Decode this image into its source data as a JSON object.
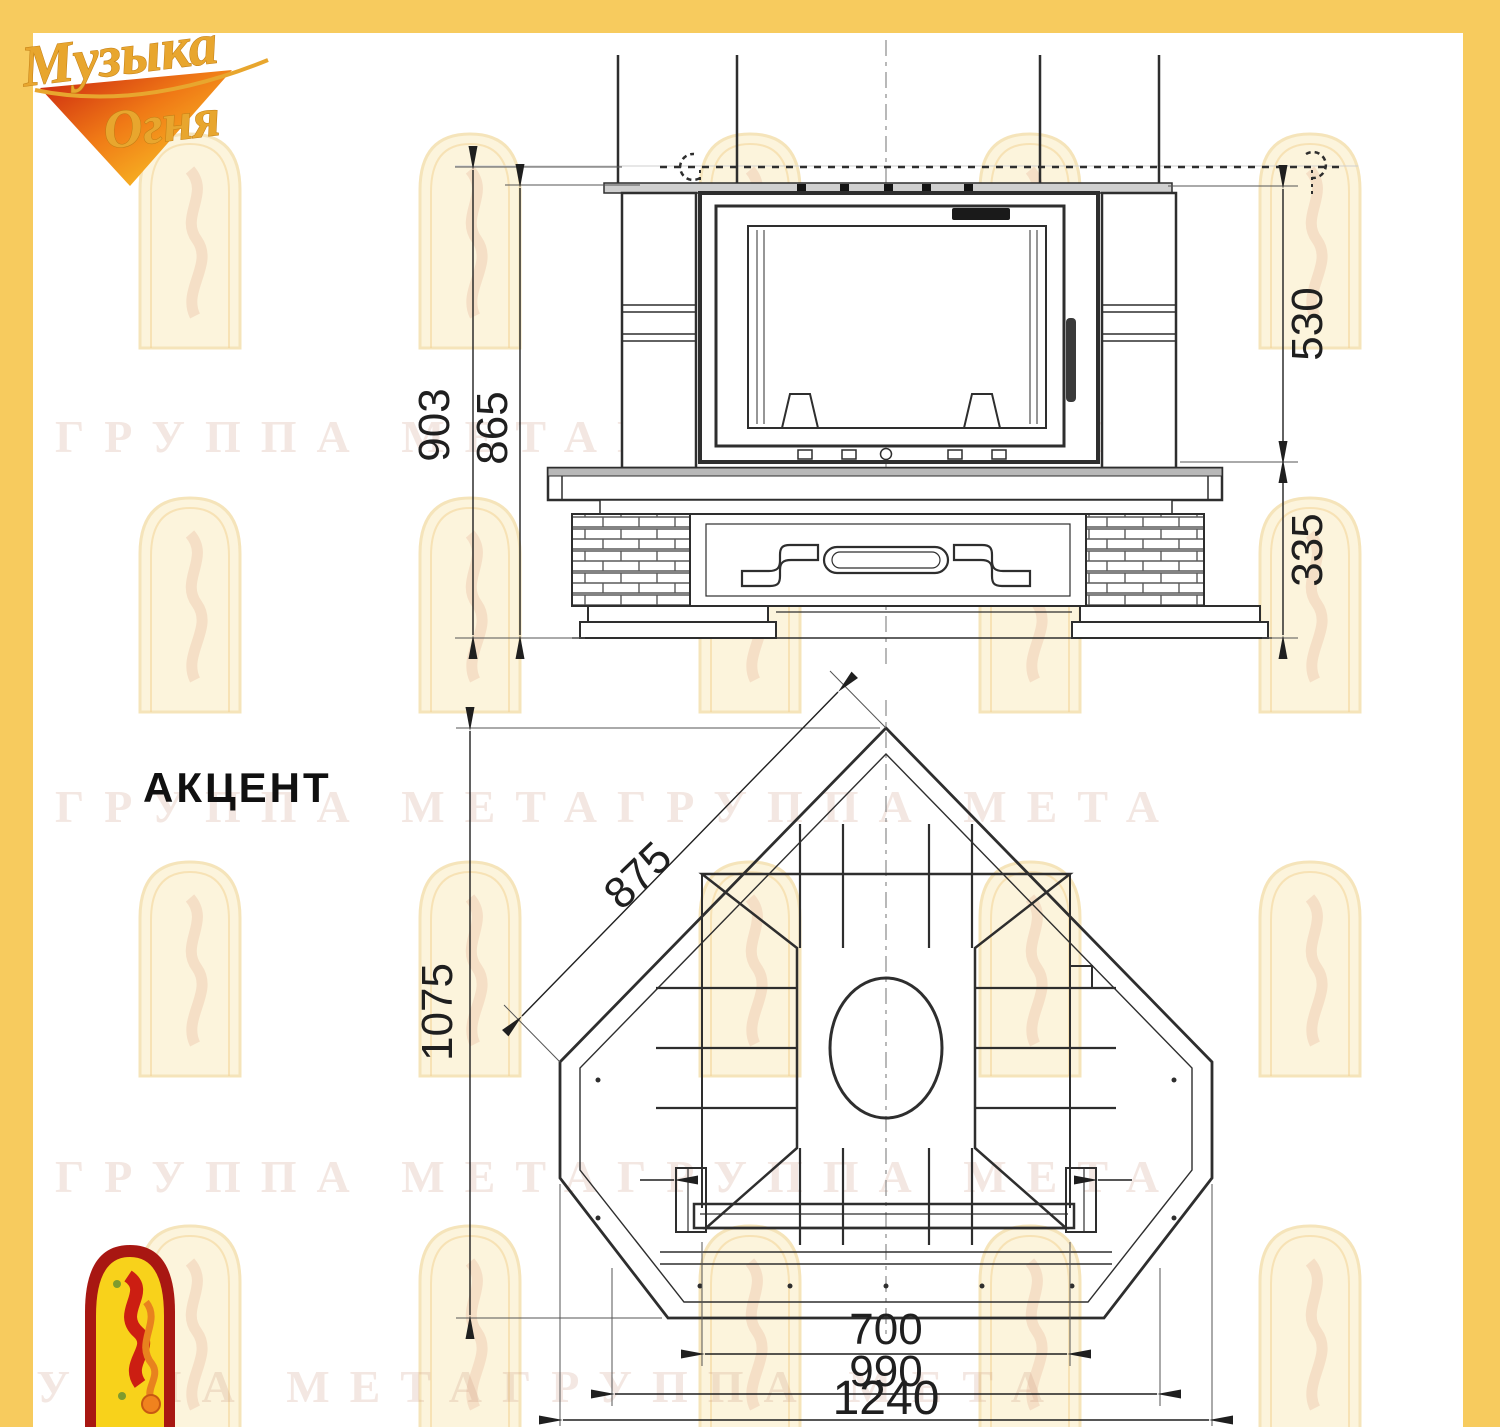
{
  "brand": {
    "name": "Музыка Огня",
    "line1": "Музыка",
    "line2": "Огня"
  },
  "model": {
    "title": "АКЦЕНТ"
  },
  "watermark": {
    "text": "ГРУППА МЕТАГРУППА МЕТА"
  },
  "dims": {
    "front": {
      "overall_height": "903",
      "mantel_height": "865",
      "upper_section": "530",
      "base_section": "335"
    },
    "plan": {
      "side_wall": "875",
      "depth": "1075",
      "firebox_width": "700",
      "hearth_width": "990",
      "overall_width": "1240"
    }
  },
  "colors": {
    "frame_yellow": "#F7CB5E",
    "drawing_line": "#2E2E2E",
    "logo_gold": "#E8A62E",
    "logo_flame_red": "#C9200F",
    "corner_arch_red": "#A81712",
    "corner_arch_yellow": "#F8D21B"
  }
}
